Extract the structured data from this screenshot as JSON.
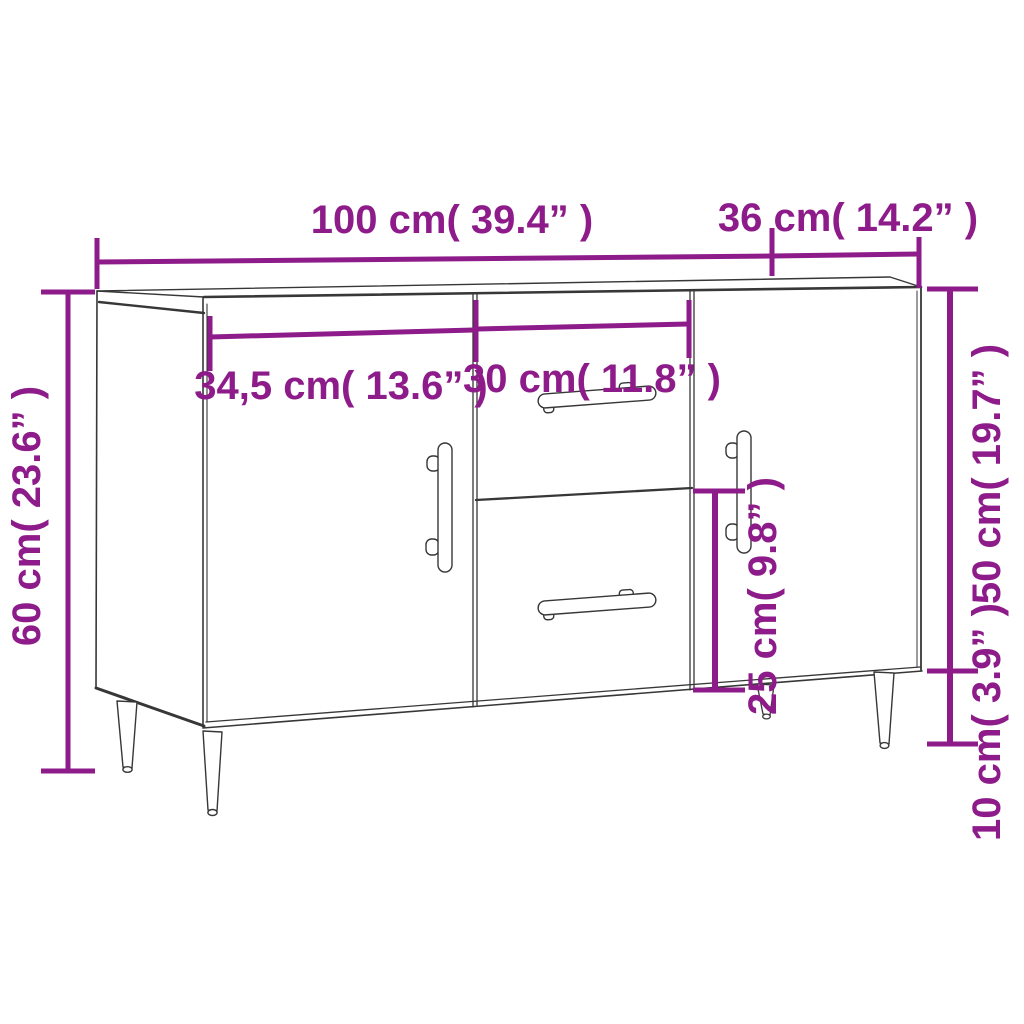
{
  "diagram": {
    "type": "furniture-dimension-diagram",
    "product": "sideboard with two doors, two drawers and four tapered legs",
    "colors": {
      "accent": "#8e1b8a",
      "line": "#373737",
      "background": "#ffffff"
    },
    "labels": {
      "overall_width": "100 cm( 39.4” )",
      "depth": "36 cm( 14.2” )",
      "left_door_width": "34,5 cm( 13.6” )",
      "middle_width": "30 cm( 11.8” )",
      "overall_height": "60 cm( 23.6” )",
      "body_height": "50 cm( 19.7” )",
      "lower_drawer_height": "25 cm( 9.8” )",
      "leg_height": "10 cm( 3.9” )"
    },
    "measurements": [
      {
        "name": "overall-width",
        "cm": "100",
        "inches": "39.4"
      },
      {
        "name": "depth",
        "cm": "36",
        "inches": "14.2"
      },
      {
        "name": "left-door-width",
        "cm": "34,5",
        "inches": "13.6"
      },
      {
        "name": "middle-section-width",
        "cm": "30",
        "inches": "11.8"
      },
      {
        "name": "overall-height",
        "cm": "60",
        "inches": "23.6"
      },
      {
        "name": "body-height",
        "cm": "50",
        "inches": "19.7"
      },
      {
        "name": "lower-drawer-height",
        "cm": "25",
        "inches": "9.8"
      },
      {
        "name": "leg-height",
        "cm": "10",
        "inches": "3.9"
      }
    ]
  }
}
